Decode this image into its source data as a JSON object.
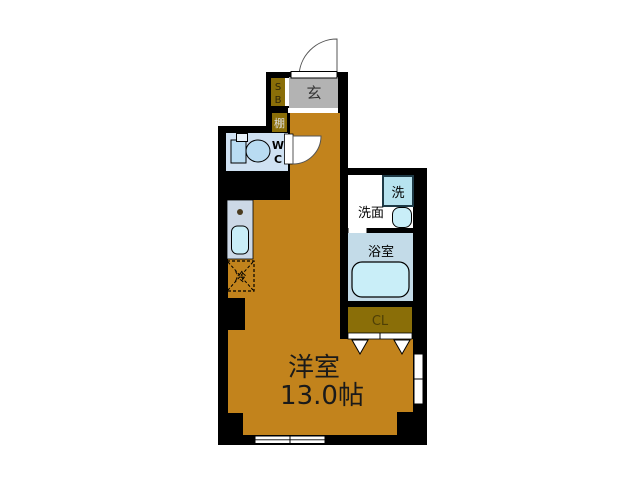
{
  "plan_title": "apartment-floor-plan",
  "rooms": {
    "entrance": {
      "label": "玄"
    },
    "shoe_box": {
      "letters": [
        "S",
        "B"
      ]
    },
    "shelf": {
      "label": "棚"
    },
    "wc": {
      "letters": [
        "W",
        "C"
      ]
    },
    "laundry": {
      "label": "洗"
    },
    "washroom": {
      "label": "洗面"
    },
    "bathroom": {
      "label": "浴室"
    },
    "closet": {
      "label": "CL"
    },
    "refrigerator": {
      "label": "冷"
    },
    "main_room": {
      "name": "洋室",
      "size": "13.0帖"
    }
  },
  "colors": {
    "wall": "#000000",
    "background": "#ffffff",
    "main_room": "#c2831c",
    "entrance_floor": "#b3b3b3",
    "storage": "#8a6e08",
    "wc_floor": "#cfe1f2",
    "wet_area": "#c3dbe8",
    "fixture": "#c9eef8",
    "toilet": "#b9dcf2",
    "counter": "#ccd8e6",
    "laundry_box": "#b7e3ef",
    "closet_text": "#4e3f06"
  }
}
